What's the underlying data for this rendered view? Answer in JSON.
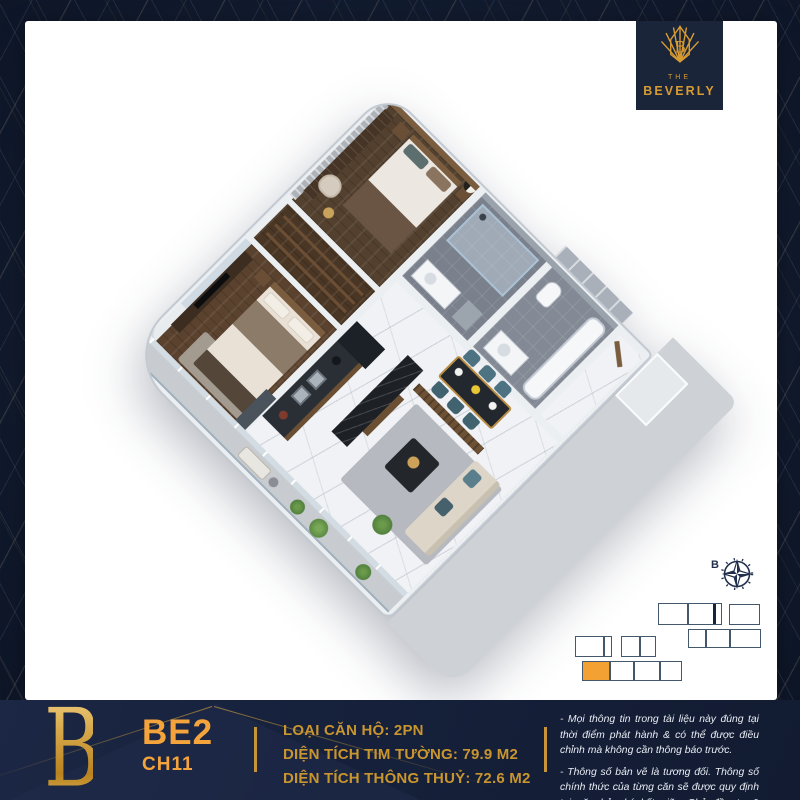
{
  "colors": {
    "navy": "#121B30",
    "gold": "#D79B33",
    "orange": "#F2A132",
    "card": "#FFFFFF",
    "spec_gold": "#C9952F"
  },
  "logo": {
    "monogram": "B",
    "word_the": "THE",
    "word_name": "BEVERLY"
  },
  "compass": {
    "label": "B"
  },
  "key_plan": {
    "border": "#44586D",
    "thick_border": "#16243A",
    "highlight": "#F2A132",
    "blocks": [
      {
        "x": 658,
        "y": 603,
        "w": 64,
        "h": 22,
        "dividers": [
          28
        ],
        "thick_dividers": [
          54
        ]
      },
      {
        "x": 729,
        "y": 604,
        "w": 31,
        "h": 21,
        "dividers": [],
        "thick_dividers": []
      },
      {
        "x": 688,
        "y": 629,
        "w": 73,
        "h": 19,
        "dividers": [
          16,
          40
        ],
        "thick_dividers": []
      },
      {
        "x": 575,
        "y": 636,
        "w": 37,
        "h": 21,
        "dividers": [
          27
        ],
        "thick_dividers": []
      },
      {
        "x": 621,
        "y": 636,
        "w": 35,
        "h": 21,
        "dividers": [
          17
        ],
        "thick_dividers": []
      },
      {
        "x": 582,
        "y": 661,
        "w": 100,
        "h": 20,
        "dividers": [
          26,
          50,
          76
        ],
        "thick_dividers": [],
        "highlight": {
          "x": 0,
          "w": 26
        }
      }
    ]
  },
  "footer": {
    "monogram": "B",
    "unit_code": "BE2",
    "unit_id": "CH11",
    "specs": [
      "LOẠI CĂN HỘ: 2PN",
      "DIỆN TÍCH TIM TƯỜNG: 79.9 M2",
      "DIỆN TÍCH THÔNG THUỶ: 72.6 M2"
    ],
    "disclaimers": [
      "- Mọi thông tin trong tài liệu này đúng tại thời điểm phát hành & có thể được điều chỉnh mà không cần thông báo trước.",
      "- Thông số bản vẽ là tương đối. Thông số chính thức của từng căn sẽ được quy định tại văn bản ký kết giữa Chủ đầu tư & khách hàng."
    ]
  }
}
